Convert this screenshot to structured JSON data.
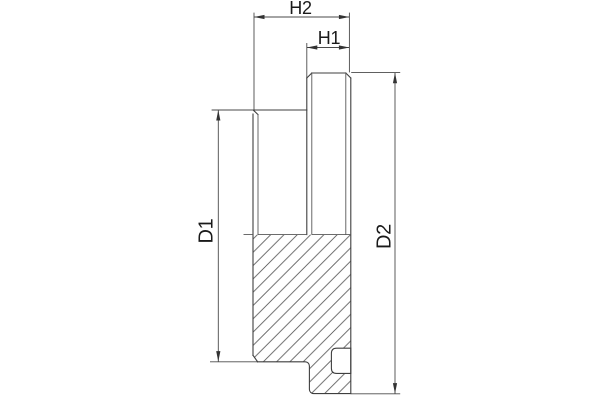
{
  "drawing": {
    "view": "cross-section-side-view",
    "dimension_labels": {
      "h2": "H2",
      "h1": "H1",
      "d1": "D1",
      "d2": "D2"
    },
    "colors": {
      "outline": "#3f3f3f",
      "thin_line": "#585858",
      "dimension_line": "#4a4a4a",
      "arrow": "#333333",
      "text": "#1a1a1a",
      "background": "#ffffff"
    },
    "hatch": {
      "style": "diagonal-45deg",
      "spacing_px": 13.3
    }
  }
}
